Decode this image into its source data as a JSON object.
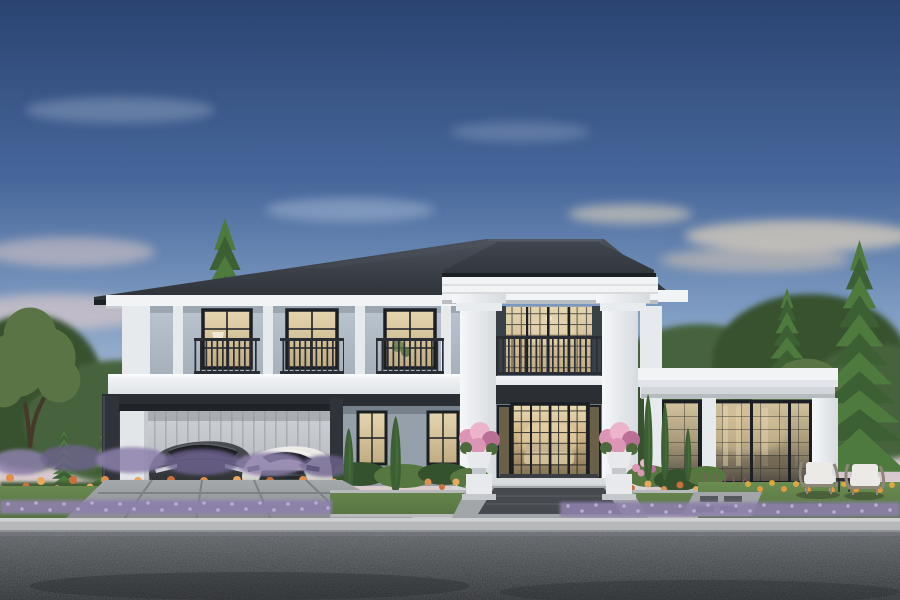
{
  "scene": {
    "description": "Twilight architectural rendering of a luxury two-storey modern classic house: dark hip roof, white cornices, central double-height portico with two square columns and wrought-iron balcony, three upper balcony windows, attached carport sheltering a dark sedan and a white sedan, single-storey glass pavilion wing on the right, pink flower urns flanking the entrance, landscaped beds of orange, purple and pink flowers, tall conifer trees on both sides, lawn with two wicker chairs, front walkway, curb and asphalt street in the foreground."
  },
  "inventory": {
    "storeys": 2,
    "portico_columns": 2,
    "upper_balcony_windows": 3,
    "balconies": 4,
    "cars": [
      "dark-sedan",
      "white-sedan"
    ],
    "flower_urns": 2,
    "outdoor_chairs": 2,
    "side_table": 1,
    "tall_conifers": 4,
    "cypress_topiaries": 5
  },
  "palette": {
    "sky_top": "#2a4371",
    "sky_upper": "#47679b",
    "sky_mid": "#7e9cc2",
    "sky_lower": "#aabbd3",
    "sky_dusk_pink": "#d5c8d0",
    "sky_horizon_peach": "#ecd9c6",
    "cloud_cool": "#c3d0e2",
    "cloud_pink": "#e9cfc9",
    "cloud_warm": "#efdcbe",
    "roof_top": "#4c525b",
    "roof_bottom": "#2a2e34",
    "roof_edge_dark": "#1d2024",
    "portico_roof_top": "#41474f",
    "portico_roof_bottom": "#30353c",
    "trim_white": "#f1f3f5",
    "trim_shadow": "#c9ced3",
    "molding_line": "#d5d9dd",
    "wall_upper_light": "#bac4ce",
    "wall_upper_dark": "#a5b0bb",
    "wall_lower": "#95a0ab",
    "corner_white": "#e7eaed",
    "frame_black": "#1b1e22",
    "glass_warm_light": "#e6d6b0",
    "glass_warm_dark": "#c0ab82",
    "door_glow": "#f3e2b8",
    "railing_iron": "#2a2e34",
    "beam_dark": "#2b2f34",
    "post_dark": "#30343a",
    "garage_light": "#ced2d7",
    "garage_dark": "#b2b6bb",
    "garage_rib": "#9fa3a8",
    "slab_top": "#f3f5f7",
    "slab_bottom": "#e0e4e8",
    "column_light": "#f5f7f9",
    "column_shade": "#d7dbdf",
    "conifer_dark": "#3c5f33",
    "conifer_light": "#4e7a3e",
    "foliage_bg": "#47633c",
    "foliage_bg_dark": "#39512f",
    "foliage_olive": "#5a7446",
    "trunk_brown": "#473929",
    "hedge_green": "#35522f",
    "boxwood": "#56773f",
    "lawn_light": "#6c8d52",
    "lawn_dark": "#52703e",
    "flower_orange": "#dd8f4e",
    "flower_orange_deep": "#c9703b",
    "flower_apricot": "#e8a95e",
    "flower_purple": "#8d80ab",
    "flower_lavender": "#b9adcf",
    "flower_pink": "#dd95b5",
    "flower_pink_light": "#ecb4ca",
    "flower_pink_deep": "#b96f96",
    "flower_yellow": "#d9a843",
    "stone_light": "#b8babc",
    "stone_mid": "#a3a6a9",
    "paver_dark": "#46494e",
    "driveway_light": "#a8abae",
    "driveway_dark": "#86898c",
    "driveway_joint": "#7b7e81",
    "curb_top": "#cfd1d3",
    "curb_face": "#b5b7b9",
    "asphalt_top": "#62666a",
    "asphalt_bottom": "#323538",
    "car_dark_top": "#4b4f54",
    "car_dark_bottom": "#26282b",
    "car_glass": "#1c1e21",
    "car_white_top": "#efede9",
    "car_white_bottom": "#c5c4c1",
    "wheel_dark": "#111316",
    "rim_gray": "#70757b",
    "wicker": "#8e8679",
    "cushion_white": "#eceae6",
    "urn_white": "#e7e9ec",
    "urn_shadow": "#c4c8cd",
    "shadow_dark": "#15171a"
  }
}
